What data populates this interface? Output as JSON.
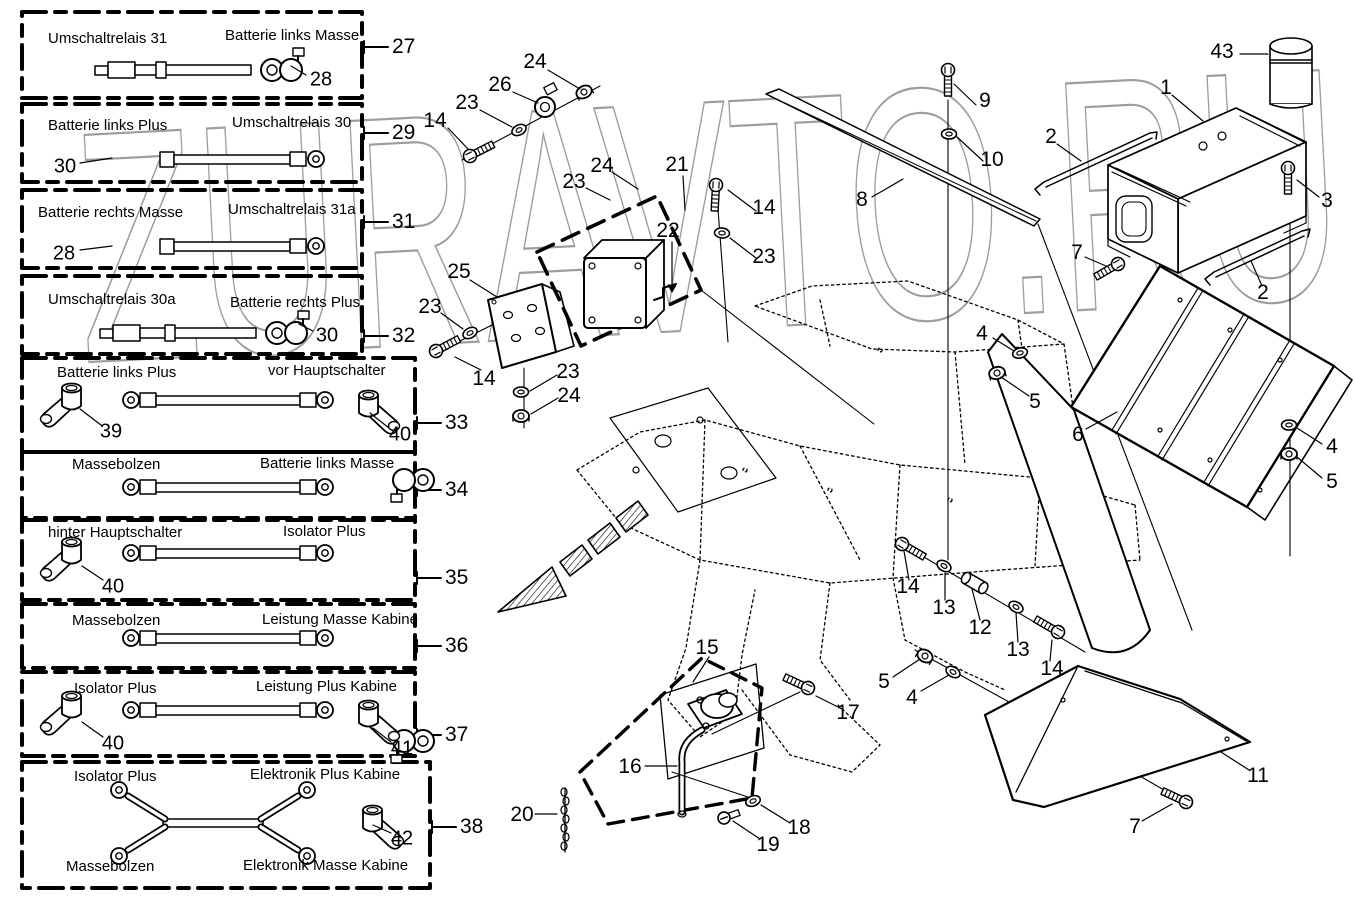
{
  "watermark": {
    "text": "ZURAVTO.RU"
  },
  "panel": {
    "boxes": [
      {
        "ref": "27",
        "labels": {
          "left": "Umschaltrelais 31",
          "right": "Batterie links Masse"
        },
        "parts": {
          "a": "28"
        }
      },
      {
        "ref": "29",
        "labels": {
          "left": "Batterie links Plus",
          "right": "Umschaltrelais 30"
        },
        "parts": {
          "a": "30"
        }
      },
      {
        "ref": "31",
        "labels": {
          "left": "Batterie rechts Masse",
          "right": "Umschaltrelais 31a"
        },
        "parts": {
          "a": "28"
        }
      },
      {
        "ref": "32",
        "labels": {
          "left": "Umschaltrelais 30a",
          "right": "Batterie rechts Plus"
        },
        "parts": {
          "a": "30"
        }
      },
      {
        "ref": "33",
        "labels": {
          "left": "Batterie links Plus",
          "right": "vor Hauptschalter"
        },
        "parts": {
          "a": "39",
          "b": "40"
        }
      },
      {
        "ref": "34",
        "labels": {
          "left": "Massebolzen",
          "right": "Batterie links Masse"
        },
        "parts": {}
      },
      {
        "ref": "35",
        "labels": {
          "left": "hinter Hauptschalter",
          "right": "Isolator Plus"
        },
        "parts": {
          "a": "40"
        }
      },
      {
        "ref": "36",
        "labels": {
          "left": "Massebolzen",
          "right": "Leistung Masse Kabine"
        },
        "parts": {}
      },
      {
        "ref": "37",
        "labels": {
          "left": "Isolator Plus",
          "right": "Leistung Plus Kabine"
        },
        "parts": {
          "a": "40",
          "b": "41"
        }
      },
      {
        "ref": "38",
        "labels": {
          "top_left": "Isolator Plus",
          "top_right": "Elektronik Plus Kabine",
          "bottom_left": "Massebolzen",
          "bottom_right": "Elektronik Masse Kabine"
        },
        "parts": {
          "a": "42"
        }
      }
    ]
  },
  "diagram": {
    "callouts": [
      {
        "n": "24",
        "x": 535,
        "y": 62
      },
      {
        "n": "26",
        "x": 500,
        "y": 85
      },
      {
        "n": "23",
        "x": 467,
        "y": 103
      },
      {
        "n": "14",
        "x": 435,
        "y": 121
      },
      {
        "n": "24",
        "x": 602,
        "y": 166
      },
      {
        "n": "23",
        "x": 574,
        "y": 182
      },
      {
        "n": "21",
        "x": 677,
        "y": 165
      },
      {
        "n": "22",
        "x": 668,
        "y": 231
      },
      {
        "n": "14",
        "x": 764,
        "y": 208
      },
      {
        "n": "23",
        "x": 764,
        "y": 257
      },
      {
        "n": "25",
        "x": 459,
        "y": 272
      },
      {
        "n": "23",
        "x": 430,
        "y": 307
      },
      {
        "n": "14",
        "x": 484,
        "y": 379
      },
      {
        "n": "23",
        "x": 568,
        "y": 372
      },
      {
        "n": "24",
        "x": 569,
        "y": 396
      },
      {
        "n": "9",
        "x": 985,
        "y": 101
      },
      {
        "n": "10",
        "x": 992,
        "y": 160
      },
      {
        "n": "8",
        "x": 862,
        "y": 200
      },
      {
        "n": "2",
        "x": 1051,
        "y": 137
      },
      {
        "n": "43",
        "x": 1222,
        "y": 52
      },
      {
        "n": "1",
        "x": 1166,
        "y": 88
      },
      {
        "n": "3",
        "x": 1327,
        "y": 201
      },
      {
        "n": "2",
        "x": 1263,
        "y": 293
      },
      {
        "n": "7",
        "x": 1077,
        "y": 253
      },
      {
        "n": "4",
        "x": 982,
        "y": 334
      },
      {
        "n": "5",
        "x": 1035,
        "y": 402
      },
      {
        "n": "6",
        "x": 1078,
        "y": 435
      },
      {
        "n": "4",
        "x": 1332,
        "y": 447
      },
      {
        "n": "5",
        "x": 1332,
        "y": 482
      },
      {
        "n": "14",
        "x": 908,
        "y": 587
      },
      {
        "n": "13",
        "x": 944,
        "y": 608
      },
      {
        "n": "12",
        "x": 980,
        "y": 628
      },
      {
        "n": "13",
        "x": 1018,
        "y": 650
      },
      {
        "n": "14",
        "x": 1052,
        "y": 669
      },
      {
        "n": "5",
        "x": 884,
        "y": 682
      },
      {
        "n": "4",
        "x": 912,
        "y": 698
      },
      {
        "n": "15",
        "x": 707,
        "y": 648
      },
      {
        "n": "17",
        "x": 848,
        "y": 713
      },
      {
        "n": "16",
        "x": 630,
        "y": 767
      },
      {
        "n": "18",
        "x": 799,
        "y": 828
      },
      {
        "n": "19",
        "x": 768,
        "y": 845
      },
      {
        "n": "20",
        "x": 522,
        "y": 815
      },
      {
        "n": "11",
        "x": 1258,
        "y": 776
      },
      {
        "n": "7",
        "x": 1135,
        "y": 827
      }
    ]
  }
}
